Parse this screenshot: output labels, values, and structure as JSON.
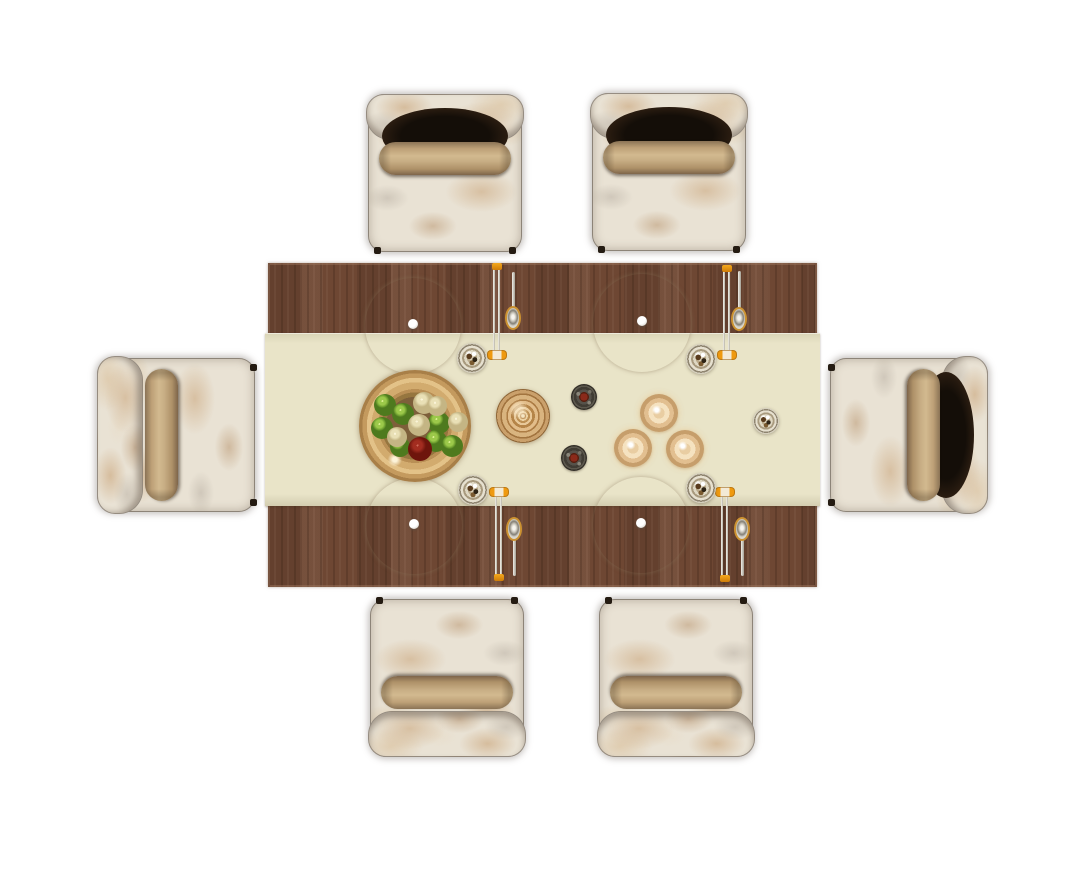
{
  "scene": {
    "description": "Top-down 3D render of a rectangular dining table for six with cream table runner, four place settings, fruit bowl and upholstered chairs",
    "background_color": "#ffffff",
    "width": 1081,
    "height": 886
  },
  "palette": {
    "orange": "#ef9a10",
    "wood": "#6e4733",
    "runner": "#e9e4c8",
    "fabric": "#e9e2d4",
    "cushion": "#c8ae85",
    "shadow_dark": "#140e08",
    "foot": "#241b12",
    "gold": "#d9b37e",
    "glass": "#d5cfbe",
    "green": "#9cc94a",
    "cream_fruit": "#e9e0b6",
    "red_fruit": "#a32d20",
    "steel": "#d9d6cd",
    "bowl_rim": "#d2ab6e",
    "bowl_inner": "#7d5f3a",
    "plate_white": "#f7f4ea",
    "plate_gray": "#bdb9ae",
    "dark_bowl": "#403c34",
    "dark_red": "#8a2a1a"
  },
  "table": {
    "x": 268,
    "y": 263,
    "width": 549,
    "height": 324
  },
  "runner": {
    "offset_y": 70,
    "height": 173,
    "overhang": 3
  },
  "chair_style": {
    "width": 154,
    "height": 158
  },
  "chairs": [
    {
      "name": "chair-top-left",
      "cx": 445,
      "cy": 173,
      "orientation": "up",
      "backrest_shadow": true
    },
    {
      "name": "chair-top-right",
      "cx": 669,
      "cy": 172,
      "orientation": "up",
      "backrest_shadow": true
    },
    {
      "name": "chair-bottom-left",
      "cx": 447,
      "cy": 678,
      "orientation": "down",
      "backrest_shadow": false
    },
    {
      "name": "chair-bottom-right",
      "cx": 676,
      "cy": 678,
      "orientation": "down",
      "backrest_shadow": false
    },
    {
      "name": "chair-left",
      "cx": 176,
      "cy": 435,
      "orientation": "left",
      "backrest_shadow": false
    },
    {
      "name": "chair-right",
      "cx": 909,
      "cy": 435,
      "orientation": "right",
      "backrest_shadow": true
    }
  ],
  "place_settings": [
    {
      "name": "place-setting-top-left",
      "cx": 413,
      "cy": 326,
      "r": 48
    },
    {
      "name": "place-setting-top-right",
      "cx": 642,
      "cy": 323,
      "r": 49
    },
    {
      "name": "place-setting-bottom-left",
      "cx": 414,
      "cy": 526,
      "r": 48
    },
    {
      "name": "place-setting-bottom-right",
      "cx": 641,
      "cy": 525,
      "r": 48
    }
  ],
  "chopstick_sets": [
    {
      "name": "chopsticks-top-left",
      "cx": 497,
      "cap_y": 263,
      "rest_y": 350,
      "dir": "down"
    },
    {
      "name": "chopsticks-top-right",
      "cx": 727,
      "cap_y": 265,
      "rest_y": 350,
      "dir": "down"
    },
    {
      "name": "chopsticks-bottom-left",
      "cx": 499,
      "cap_y": 574,
      "rest_y": 487,
      "dir": "up"
    },
    {
      "name": "chopsticks-bottom-right",
      "cx": 725,
      "cap_y": 575,
      "rest_y": 487,
      "dir": "up"
    }
  ],
  "spoons": [
    {
      "name": "spoon-top-left",
      "cx": 513,
      "bowl_cy": 318,
      "handle_to": 272
    },
    {
      "name": "spoon-top-right",
      "cx": 739,
      "bowl_cy": 319,
      "handle_to": 271
    },
    {
      "name": "spoon-bottom-left",
      "cx": 514,
      "bowl_cy": 529,
      "handle_to": 576
    },
    {
      "name": "spoon-bottom-right",
      "cx": 742,
      "bowl_cy": 529,
      "handle_to": 576
    }
  ],
  "condiment_dishes": [
    {
      "name": "condiment-dish-top-left",
      "cx": 472,
      "cy": 358,
      "r": 15
    },
    {
      "name": "condiment-dish-top-right",
      "cx": 701,
      "cy": 359,
      "r": 15
    },
    {
      "name": "condiment-dish-bottom-left",
      "cx": 473,
      "cy": 490,
      "r": 15
    },
    {
      "name": "condiment-dish-bottom-right",
      "cx": 701,
      "cy": 488,
      "r": 15
    },
    {
      "name": "condiment-dish-right",
      "cx": 766,
      "cy": 421,
      "r": 13
    }
  ],
  "sauce_bowls": [
    {
      "name": "sauce-bowl-upper",
      "cx": 584,
      "cy": 397,
      "r": 13
    },
    {
      "name": "sauce-bowl-lower",
      "cx": 574,
      "cy": 458,
      "r": 13
    }
  ],
  "gold_cups": [
    {
      "name": "gold-cup-top",
      "cx": 659,
      "cy": 413,
      "r": 19
    },
    {
      "name": "gold-cup-left",
      "cx": 633,
      "cy": 448,
      "r": 19
    },
    {
      "name": "gold-cup-right",
      "cx": 685,
      "cy": 449,
      "r": 19
    }
  ],
  "tureen": {
    "cx": 523,
    "cy": 416,
    "r": 27
  },
  "fruit_bowl": {
    "cx": 415,
    "cy": 426,
    "r": 56,
    "fruits": [
      {
        "type": "green",
        "cx": 385,
        "cy": 405,
        "r": 11
      },
      {
        "type": "green",
        "cx": 403,
        "cy": 414,
        "r": 11
      },
      {
        "type": "green",
        "cx": 382,
        "cy": 428,
        "r": 11
      },
      {
        "type": "green",
        "cx": 439,
        "cy": 423,
        "r": 11
      },
      {
        "type": "green",
        "cx": 436,
        "cy": 441,
        "r": 11
      },
      {
        "type": "green",
        "cx": 452,
        "cy": 446,
        "r": 11
      },
      {
        "type": "green",
        "cx": 400,
        "cy": 447,
        "r": 10
      },
      {
        "type": "cream",
        "cx": 424,
        "cy": 403,
        "r": 11
      },
      {
        "type": "cream",
        "cx": 437,
        "cy": 406,
        "r": 10
      },
      {
        "type": "cream",
        "cx": 419,
        "cy": 425,
        "r": 11
      },
      {
        "type": "cream",
        "cx": 458,
        "cy": 422,
        "r": 10
      },
      {
        "type": "cream",
        "cx": 397,
        "cy": 437,
        "r": 10
      },
      {
        "type": "red",
        "cx": 420,
        "cy": 449,
        "r": 12
      }
    ]
  }
}
